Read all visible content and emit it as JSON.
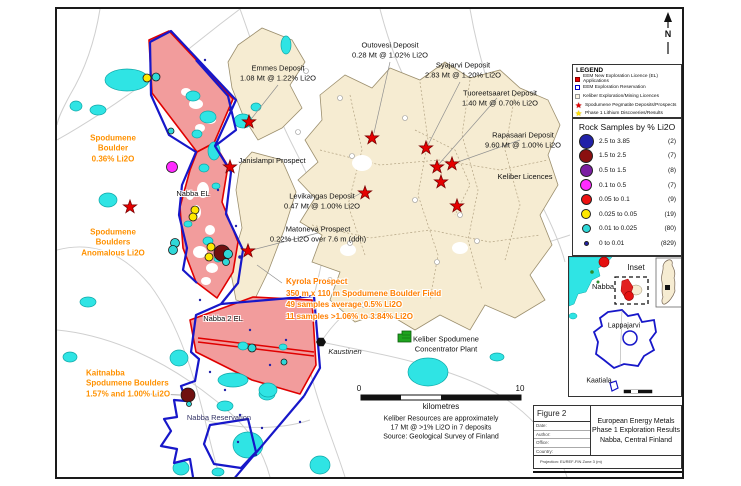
{
  "north_arrow": {
    "label": "N"
  },
  "legend": {
    "title": "LEGEND",
    "items": [
      {
        "label": "EEM New Exploration Licence (EL) Applications",
        "swatch": "red-square"
      },
      {
        "label": "EEM Exploration Reservation",
        "swatch": "blue-outline-square"
      },
      {
        "label": "Keliber Exploration/Mining Licences",
        "swatch": "beige-square"
      },
      {
        "label": "Spodumene Pegmatite Deposits/Prospects",
        "swatch": "red-star"
      },
      {
        "label": "Phase 1 Lithium Discoveries/Results",
        "swatch": "yellow-star"
      }
    ]
  },
  "rock_samples": {
    "title": "Rock Samples by % Li2O",
    "classes": [
      {
        "range": "2.5 to 3.85",
        "count": "(2)",
        "color": "#2222A8",
        "diameter": 13
      },
      {
        "range": "1.5 to 2.5",
        "count": "(7)",
        "color": "#8B1010",
        "diameter": 12
      },
      {
        "range": "0.5 to 1.5",
        "count": "(8)",
        "color": "#7B1FA2",
        "diameter": 11
      },
      {
        "range": "0.1 to 0.5",
        "count": "(7)",
        "color": "#FF2BFF",
        "diameter": 10
      },
      {
        "range": "0.05 to 0.1",
        "count": "(9)",
        "color": "#EE1111",
        "diameter": 9
      },
      {
        "range": "0.025 to 0.05",
        "count": "(19)",
        "color": "#FFE800",
        "diameter": 8
      },
      {
        "range": "0.01 to 0.025",
        "count": "(80)",
        "color": "#2FD8D8",
        "diameter": 7
      },
      {
        "range": "0 to 0.01",
        "count": "(829)",
        "color": "#2222A8",
        "diameter": 3
      }
    ]
  },
  "map": {
    "deposits": {
      "outovesi": {
        "name": "Outovesi Deposit",
        "grade": "0.28 Mt @ 1.02% Li2O"
      },
      "emmes": {
        "name": "Emmes Deposit",
        "grade": "1.08 Mt @ 1.22% Li2O"
      },
      "syajarvi": {
        "name": "Syajarvi Deposit",
        "grade": "2.83 Mt @ 1.20% Li2O"
      },
      "tuoreetsaaret": {
        "name": "Tuoreetsaaret Deposit",
        "grade": "1.40 Mt @ 0.70% Li2O"
      },
      "rapasaari": {
        "name": "Rapasaari Deposit",
        "grade": "9.60 Mt @ 1.00% Li2O"
      },
      "levikangas": {
        "name": "Levikangas Deposit",
        "grade": "0.47 Mt @ 1.00% Li2O"
      },
      "matoneva": {
        "name": "Matoneva Prospect",
        "grade": "0.22% Li2O over 7.6 m (ddh)"
      },
      "janislampi": {
        "name": "Janislampi Prospect"
      }
    },
    "areas": {
      "nabba_el": "Nabba EL",
      "nabba2_el": "Nabba 2 EL",
      "nabba_reservation": "Nabba Reservation",
      "keliber_licences": "Keliber Licences"
    },
    "towns": {
      "kaustinen": "Kaustinen"
    },
    "plant": {
      "lines": [
        "Keliber Spodumene",
        "Concentrator Plant"
      ]
    },
    "annotations": {
      "boulder_036": {
        "lines": [
          "Spodumene",
          "Boulder",
          "0.36% Li2O"
        ]
      },
      "boulders_anomalous": {
        "lines": [
          "Spodumene",
          "Boulders",
          "Anomalous Li2O"
        ]
      },
      "kyrola": {
        "lines": [
          "Kyrola Prospect",
          "350 m x 110 m Spodumene Boulder Field",
          "49 samples average 0.5% Li2O",
          "11 samples >1.06% to 3.84% Li2O"
        ]
      },
      "kaitnabba": {
        "lines": [
          "Kaitnabba",
          "Spodumene Boulders",
          "1.57% and 1.00% Li2O"
        ]
      }
    },
    "colors": {
      "eem_licence_fill": "#F29C9C",
      "eem_licence_border": "#E00000",
      "reservation_outline": "#1717C9",
      "keliber_licence_fill": "#F6ECD2",
      "water": "#2FE4E4",
      "annotation_orange": "#FF9100"
    }
  },
  "scale_bar": {
    "start": "0",
    "end": "10",
    "unit": "kilometres"
  },
  "source_note": {
    "lines": [
      "Keliber Resources are approximately",
      "17 Mt @ >1% Li2O in 7 deposits",
      "Source: Geological Survey of Finland"
    ]
  },
  "inset": {
    "title": "Inset",
    "labels": {
      "nabba": "Nabba",
      "lappajarvi": "Lappajarvi",
      "kaatiala": "Kaatiala"
    }
  },
  "title_block": {
    "figure_number": "Figure 2",
    "meta_rows": [
      "Date:",
      "Author:",
      "Office:",
      "Country:"
    ],
    "title_lines": [
      "European Energy Metals",
      "Phase 1 Exploration Results",
      "Nabba, Central Finland"
    ],
    "projection_note": "Projection: EUREF-FIN Zone 3 (m)"
  }
}
